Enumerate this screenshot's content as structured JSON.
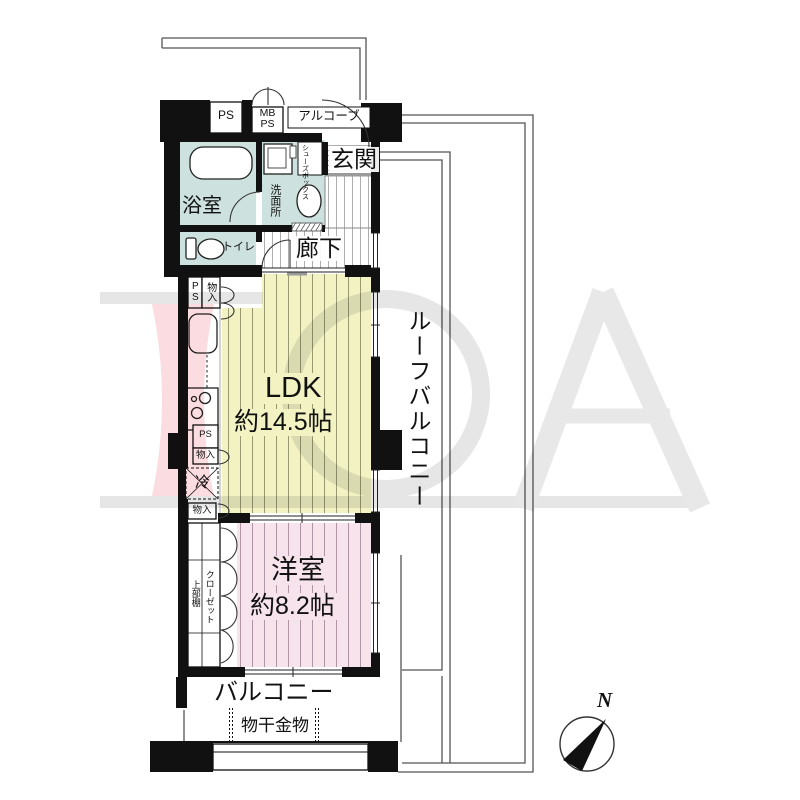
{
  "floor_plan": {
    "rooms": {
      "ldk": {
        "name": "LDK",
        "size": "約14.5帖"
      },
      "western_room": {
        "name": "洋室",
        "size": "約8.2帖"
      },
      "bathroom": {
        "name": "浴室"
      },
      "washroom": {
        "name": "洗面所"
      },
      "toilet": {
        "name": "トイレ"
      },
      "hallway": {
        "name": "廊下"
      },
      "entrance": {
        "name": "玄関"
      },
      "alcove": {
        "name": "アルコーブ"
      },
      "balcony": {
        "name": "バルコニー"
      },
      "roof_balcony": {
        "name": "ルーフバルコニー"
      }
    },
    "labels": {
      "ps": "PS",
      "mb": "MB",
      "storage": "物入",
      "shoes_box": "シューズボックス",
      "refrigerator": "冷",
      "closet": "クローゼット",
      "upper_shelf": "上部棚",
      "laundry_hardware": "物干金物"
    },
    "compass": {
      "north": "N"
    },
    "colors": {
      "ldk_fill": "#f2f2c3",
      "western_fill": "#f7e3ec",
      "wet_area_fill": "#cde2de",
      "refrigerator_fill": "#f0d8ad",
      "wall": "#111111",
      "watermark_pink": "#fbdce0",
      "watermark_gray": "#e6e6e6"
    }
  }
}
